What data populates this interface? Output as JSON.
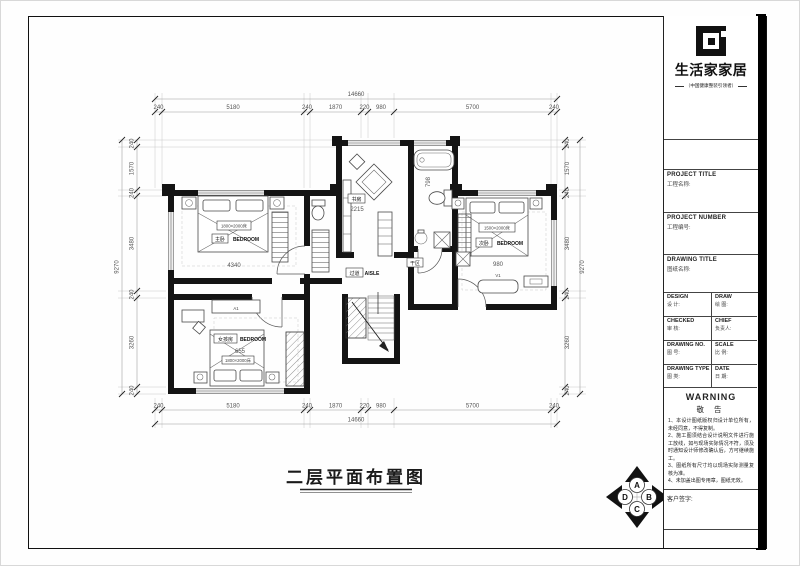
{
  "sheet": {
    "plan_title": "二层平面布置图"
  },
  "brand": {
    "name": "生活家家居",
    "tagline": "（中国健康整装引领者）"
  },
  "title_block": {
    "project_title_en": "PROJECT TITLE",
    "project_title_zh": "工程名称:",
    "project_number_en": "PROJECT NUMBER",
    "project_number_zh": "工程编号:",
    "drawing_title_en": "DRAWING TITLE",
    "drawing_title_zh": "图纸名称:",
    "grid": [
      {
        "en": "DESIGN",
        "zh": "设 计:"
      },
      {
        "en": "DRAW",
        "zh": "绘 图:"
      },
      {
        "en": "CHECKED",
        "zh": "审 核:"
      },
      {
        "en": "CHIEF",
        "zh": "负责人:"
      },
      {
        "en": "DRAWING NO.",
        "zh": "图 号:"
      },
      {
        "en": "SCALE",
        "zh": "比 例:"
      },
      {
        "en": "DRAWING TYPE",
        "zh": "图 类:"
      },
      {
        "en": "DATE",
        "zh": "日 期:"
      }
    ],
    "warning_en": "WARNING",
    "warning_zh": "敬 告",
    "warnings": [
      "1、本设计图纸版权归设计单位所有，未经同意，不得复制。",
      "2、施工图须结合设计说明文件进行施工放线，如与现场实际情况不符，须及时通知设计师修改确认后，方可继续施工。",
      "3、图纸所有尺寸均以现场实际测量复核为准。",
      "4、未加盖出图专用章，图纸无效。"
    ],
    "signature": "客户签字:"
  },
  "dims": {
    "h_total": "14660",
    "h_segments": [
      "240",
      "5180",
      "240",
      "1870",
      "220",
      "980",
      "5700",
      "240"
    ],
    "v_total": "9270",
    "v_segments": [
      "240",
      "1570",
      "240",
      "3480",
      "240",
      "3260",
      "240"
    ]
  },
  "rooms": {
    "master": {
      "zh": "主卧",
      "en": "BEDROOM",
      "bed_size": "1800×2000床",
      "width": "4340"
    },
    "study": {
      "zh": "书房",
      "width": "2215"
    },
    "bath": {
      "dry": "干区",
      "dim": "798"
    },
    "second": {
      "zh": "次卧",
      "en": "BEDROOM",
      "bed_size": "1500×2000床",
      "width": "980",
      "bench": "V1"
    },
    "kids": {
      "zh": "女孩房",
      "en": "BEDROOM",
      "bed_size": "1800×2000床",
      "width": "655",
      "cabinet": "A1"
    },
    "aisle": {
      "zh": "过道",
      "en": "AISLE"
    }
  },
  "compass": {
    "top": "A",
    "right": "B",
    "bottom": "C",
    "left": "D"
  }
}
